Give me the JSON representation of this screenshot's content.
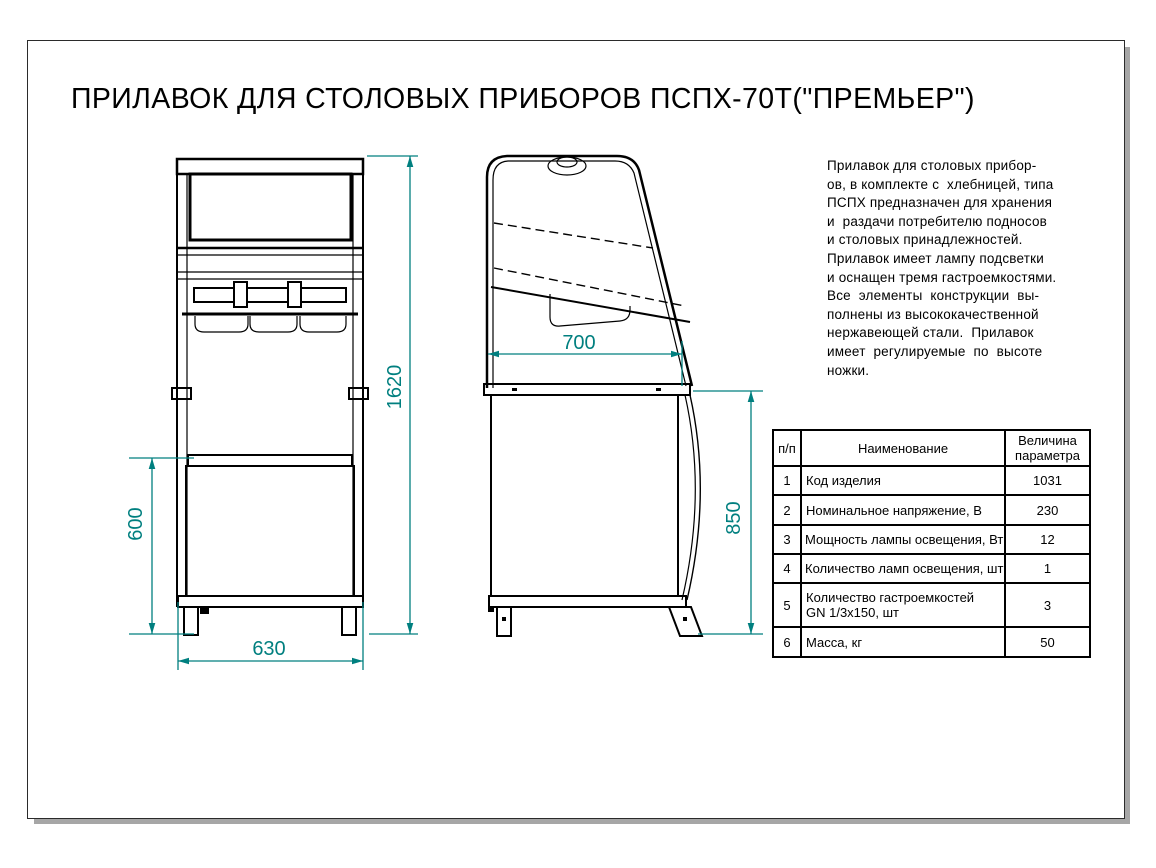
{
  "title": "ПРИЛАВОК ДЛЯ СТОЛОВЫХ ПРИБОРОВ ПСПХ-70Т(\"ПРЕМЬЕР\")",
  "description": "Прилавок для столовых прибор-\nов, в комплекте с  хлебницей, типа\nПСПХ предназначен для хранения\nи  раздачи потребителю подносов\nи столовых принадлежностей.\nПрилавок имеет лампу подсветки\nи оснащен тремя гастроемкостями.\nВсе  элементы  конструкции  вы-\nполнены из высококачественной\nнержавеющей стали.  Прилавок\nимеет  регулируемые  по  высоте\nножки.",
  "drawing": {
    "front_view": {
      "dim_height": "1620",
      "dim_lower": "600",
      "dim_width": "630"
    },
    "side_view": {
      "dim_top_width": "700",
      "dim_counter_height": "850"
    }
  },
  "table": {
    "headers": {
      "num": "п/п",
      "name": "Наименование",
      "value": "Величина параметра"
    },
    "rows": [
      {
        "num": "1",
        "name": "Код изделия",
        "value": "1031"
      },
      {
        "num": "2",
        "name": "Номинальное напряжение, В",
        "value": "230"
      },
      {
        "num": "3",
        "name": "Мощность лампы освещения, Вт",
        "value": "12"
      },
      {
        "num": "4",
        "name": "Количество ламп освещения, шт",
        "value": "1"
      },
      {
        "num": "5",
        "name": "Количество гастроемкостей\nGN 1/3x150, шт",
        "value": "3"
      },
      {
        "num": "6",
        "name": "Масса, кг",
        "value": "50"
      }
    ]
  },
  "colors": {
    "dimension_accent": "#007f7f",
    "drawing_line": "#000000"
  }
}
